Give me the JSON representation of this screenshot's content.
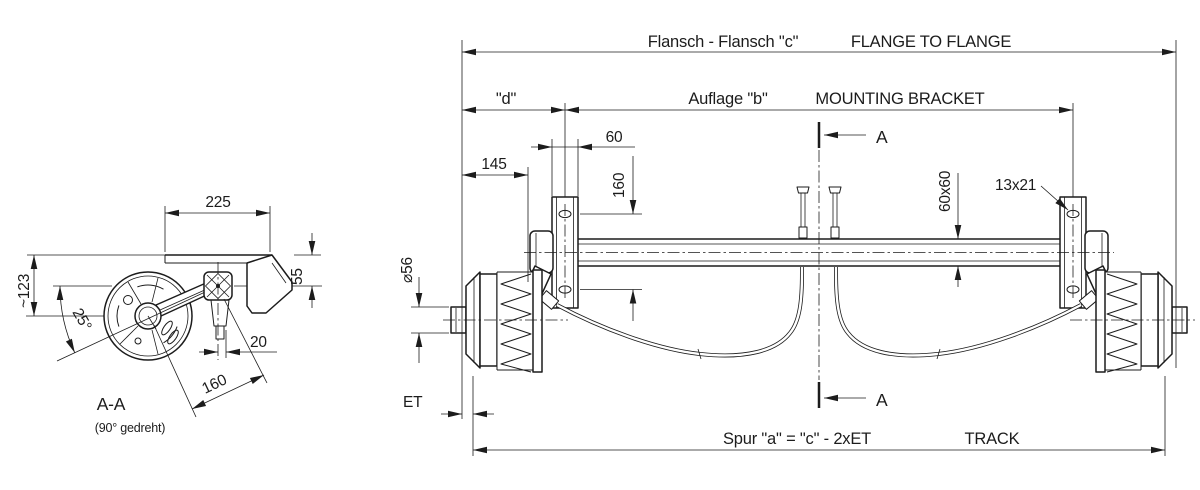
{
  "header": {
    "flansch_c_de": "Flansch - Flansch \"c\"",
    "flange_en": "FLANGE TO FLANGE",
    "d_ref": "\"d\"",
    "auflage_b_de": "Auflage \"b\"",
    "mounting_bracket_en": "MOUNTING BRACKET"
  },
  "footer": {
    "et_label": "ET",
    "spur_formula": "Spur \"a\" = \"c\" - 2xET",
    "track_en": "TRACK"
  },
  "section": {
    "cut_mark": "A",
    "view_title": "A-A",
    "view_note": "(90° gedreht)"
  },
  "dims": {
    "bracket_width": "60",
    "flange_to_bracket": "145",
    "bracket_hole_spacing": "160",
    "tube_section": "60x60",
    "bracket_slot": "13x21",
    "stub_diameter": "⌀56",
    "plate_width": "225",
    "plate_to_tube_center": "55",
    "plate_to_stub_center": "~123",
    "arm_angle": "25°",
    "damper_offset": "20",
    "arm_length": "160"
  },
  "colors": {
    "line": "#1c1c1c",
    "background": "#ffffff"
  }
}
